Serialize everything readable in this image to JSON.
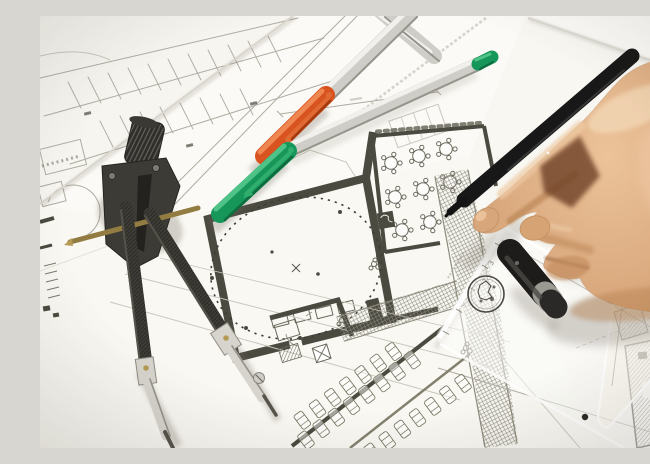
{
  "scene": {
    "description": "Close-up photograph of a right hand drawing with a black pen over overlapping architectural blueprint sheets; a divider compass, orange-capped and green-capped silver marker pens, a black pen cap, a transparent scale ruler with a round stamp logo, and a transparent set square lie on the plans."
  },
  "objects": {
    "hand": {
      "label": "right hand holding drawing pen",
      "skin_color": "#d8a67b"
    },
    "drawing_pen": {
      "label": "black fineliner pen",
      "color": "#181818"
    },
    "pen_cap": {
      "label": "black pen cap with grey ring",
      "color": "#1d1c1a"
    },
    "compass": {
      "label": "divider compass with brass adjusting screw",
      "body_color": "#312f2a",
      "screw_color": "#b59a55"
    },
    "marker_pen_orange": {
      "label": "silver marker pen with orange cap",
      "cap_color": "#d8531f"
    },
    "marker_pen_green": {
      "label": "silver marker pen with green cap and green tail plug",
      "cap_color": "#17965a"
    },
    "scale_ruler": {
      "label": "transparent scale ruler with round stamp",
      "tick_labels": [
        "3",
        "7"
      ]
    },
    "set_square": {
      "label": "transparent set square with black dot",
      "dot_color": "#2b2a26"
    },
    "blueprints": {
      "label": "overlapping architectural plan sheets",
      "features": [
        "site plan with parking stall rows",
        "room with large dashed circle",
        "hall with round tables and chairs",
        "cross-hatched corridor",
        "parking bays with car symbols",
        "hatched wall sections",
        "dimension lines"
      ]
    }
  },
  "colors": {
    "desk": "#e9e7e1",
    "paper": "#fbfaf7",
    "plan_line": "#aeaba1",
    "plan_faint": "#c9c6bc",
    "wall_ink": "#4b4a40",
    "hatch": "#8e8b7d",
    "plastic_dark": "#312f2a",
    "plastic_mid": "#55534a",
    "steel": "#d6d4cd",
    "steel_edge": "#95928a",
    "brass": "#b59a55",
    "silver": "#cfcdc7",
    "silver_hi": "#f1f0ec",
    "silver_edge": "#97948c",
    "orange": "#d8531f",
    "orange_hi": "#ef8752",
    "orange_dk": "#a23a10",
    "green": "#17965a",
    "green_hi": "#4fc287",
    "green_dk": "#0d6b3e",
    "pen_black": "#181818",
    "pen_sheen": "#3f3f3f",
    "cap_black": "#1d1c1a",
    "cap_ring": "#9b9a92",
    "skin": "#d8a67b",
    "skin_hi": "#f1d3b2",
    "skin_mid": "#c08a5e",
    "skin_dk": "#8a5632",
    "skin_deep": "#6e4126",
    "shadow": "rgba(108,100,86,0.28)"
  }
}
